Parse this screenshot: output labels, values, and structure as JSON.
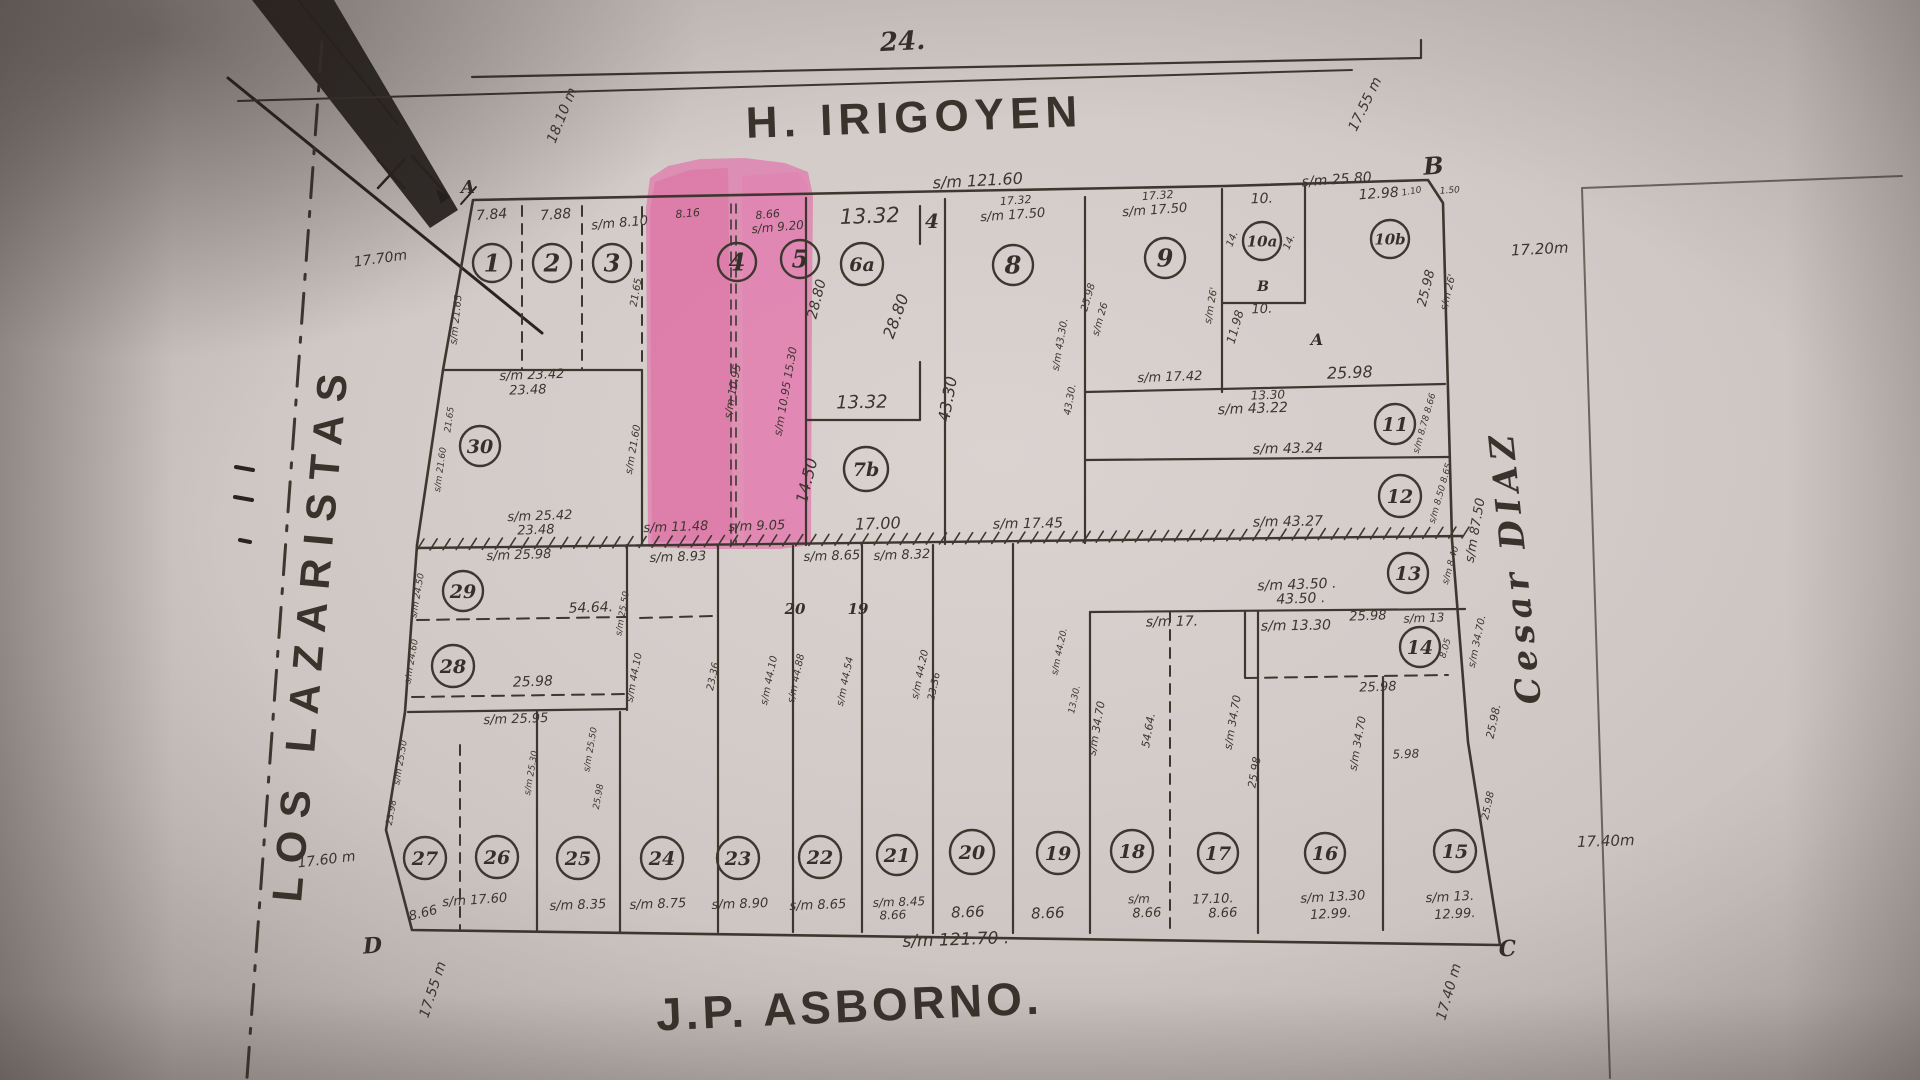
{
  "streets": {
    "top": "H. IRIGOYEN",
    "bottom": "J.P. ASBORNO.",
    "left": "LOS LAZARISTAS",
    "right": "Cesar DIAZ"
  },
  "block": {
    "across_number": "24."
  },
  "frontages": {
    "top": "s/m 121.60",
    "bottom": "s/m 121.70 ."
  },
  "colors": {
    "ink": "#3e372f",
    "paper": "#d3cbc8",
    "highlight": "#e8469a"
  },
  "highlight": {
    "lots": "4, 5"
  },
  "map": {
    "lots": [
      {
        "n": "1",
        "x": 492,
        "y": 263,
        "r": 19
      },
      {
        "n": "2",
        "x": 552,
        "y": 263,
        "r": 19
      },
      {
        "n": "3",
        "x": 612,
        "y": 263,
        "r": 19
      },
      {
        "n": "4",
        "x": 737,
        "y": 262,
        "r": 19
      },
      {
        "n": "5",
        "x": 800,
        "y": 259,
        "r": 19
      },
      {
        "n": "6a",
        "x": 862,
        "y": 264,
        "r": 21
      },
      {
        "n": "8",
        "x": 1013,
        "y": 265,
        "r": 20
      },
      {
        "n": "9",
        "x": 1165,
        "y": 258,
        "r": 20
      },
      {
        "n": "10a",
        "x": 1262,
        "y": 241,
        "r": 19
      },
      {
        "n": "10b",
        "x": 1390,
        "y": 239,
        "r": 19
      },
      {
        "n": "7b",
        "x": 866,
        "y": 469,
        "r": 22
      },
      {
        "n": "11",
        "x": 1395,
        "y": 424,
        "r": 20
      },
      {
        "n": "12",
        "x": 1400,
        "y": 496,
        "r": 21
      },
      {
        "n": "13",
        "x": 1408,
        "y": 573,
        "r": 20
      },
      {
        "n": "14",
        "x": 1420,
        "y": 647,
        "r": 20
      },
      {
        "n": "30",
        "x": 480,
        "y": 446,
        "r": 20
      },
      {
        "n": "29",
        "x": 463,
        "y": 591,
        "r": 20
      },
      {
        "n": "28",
        "x": 453,
        "y": 666,
        "r": 21
      },
      {
        "n": "27",
        "x": 425,
        "y": 858,
        "r": 21
      },
      {
        "n": "26",
        "x": 497,
        "y": 857,
        "r": 21
      },
      {
        "n": "25",
        "x": 578,
        "y": 858,
        "r": 21
      },
      {
        "n": "24",
        "x": 662,
        "y": 858,
        "r": 21
      },
      {
        "n": "23",
        "x": 738,
        "y": 858,
        "r": 21
      },
      {
        "n": "22",
        "x": 820,
        "y": 857,
        "r": 21
      },
      {
        "n": "21",
        "x": 897,
        "y": 855,
        "r": 20
      },
      {
        "n": "20",
        "x": 972,
        "y": 852,
        "r": 22
      },
      {
        "n": "19",
        "x": 1058,
        "y": 853,
        "r": 21
      },
      {
        "n": "18",
        "x": 1132,
        "y": 851,
        "r": 21
      },
      {
        "n": "17",
        "x": 1218,
        "y": 853,
        "r": 20
      },
      {
        "n": "16",
        "x": 1325,
        "y": 853,
        "r": 20
      },
      {
        "n": "15",
        "x": 1455,
        "y": 851,
        "r": 21
      }
    ],
    "labels": [
      {
        "t": "7.84",
        "x": 492,
        "y": 219,
        "r": -4,
        "s": 14
      },
      {
        "t": "7.88",
        "x": 556,
        "y": 219,
        "r": -4,
        "s": 14
      },
      {
        "t": "s/m 8.10",
        "x": 620,
        "y": 227,
        "r": -5,
        "s": 13
      },
      {
        "t": "8.16",
        "x": 688,
        "y": 217,
        "r": -5,
        "s": 11
      },
      {
        "t": "8.66",
        "x": 768,
        "y": 218,
        "r": -5,
        "s": 11
      },
      {
        "t": "s/m 9.20",
        "x": 778,
        "y": 231,
        "r": -5,
        "s": 12
      },
      {
        "t": "13.32",
        "x": 870,
        "y": 223,
        "r": -2,
        "s": 21
      },
      {
        "t": "17.32",
        "x": 1016,
        "y": 204,
        "r": -4,
        "s": 11
      },
      {
        "t": "s/m 17.50",
        "x": 1013,
        "y": 219,
        "r": -4,
        "s": 13
      },
      {
        "t": "17.32",
        "x": 1158,
        "y": 199,
        "r": -4,
        "s": 11
      },
      {
        "t": "s/m 17.50",
        "x": 1155,
        "y": 214,
        "r": -4,
        "s": 13
      },
      {
        "t": "s/m 25.80",
        "x": 1337,
        "y": 184,
        "r": -4,
        "s": 14
      },
      {
        "t": "10.",
        "x": 1262,
        "y": 203,
        "r": -2,
        "s": 14
      },
      {
        "t": "12.98",
        "x": 1379,
        "y": 198,
        "r": -4,
        "s": 14
      },
      {
        "t": "1.10",
        "x": 1412,
        "y": 194,
        "r": -10,
        "s": 9
      },
      {
        "t": "1.50",
        "x": 1450,
        "y": 193,
        "r": -4,
        "s": 9
      },
      {
        "t": "18.10 m",
        "x": 566,
        "y": 117,
        "r": -68,
        "s": 14
      },
      {
        "t": "17.70m",
        "x": 381,
        "y": 263,
        "r": -8,
        "s": 14
      },
      {
        "t": "17.55 m",
        "x": 1369,
        "y": 106,
        "r": -64,
        "s": 14
      },
      {
        "t": "17.20m",
        "x": 1540,
        "y": 254,
        "r": -3,
        "s": 15
      },
      {
        "t": "s/m 21.65",
        "x": 459,
        "y": 320,
        "r": -84,
        "s": 10
      },
      {
        "t": "21.65",
        "x": 639,
        "y": 293,
        "r": -80,
        "s": 10
      },
      {
        "t": "s/m 21.60",
        "x": 636,
        "y": 450,
        "r": -80,
        "s": 10
      },
      {
        "t": "s/m 10.95",
        "x": 736,
        "y": 392,
        "r": -80,
        "s": 11
      },
      {
        "t": "s/m 10.95 15.30",
        "x": 789,
        "y": 392,
        "r": -80,
        "s": 11
      },
      {
        "t": "28.80",
        "x": 821,
        "y": 300,
        "r": -76,
        "s": 14
      },
      {
        "t": "28.80",
        "x": 901,
        "y": 318,
        "r": -70,
        "s": 16
      },
      {
        "t": "s/m 23.42",
        "x": 532,
        "y": 379,
        "r": -2,
        "s": 13
      },
      {
        "t": "23.48",
        "x": 528,
        "y": 394,
        "r": -2,
        "s": 13
      },
      {
        "t": "21.65",
        "x": 452,
        "y": 420,
        "r": -82,
        "s": 9
      },
      {
        "t": "s/m 21.60",
        "x": 443,
        "y": 470,
        "r": -82,
        "s": 9
      },
      {
        "t": "s/m 25.42",
        "x": 540,
        "y": 520,
        "r": -2,
        "s": 13
      },
      {
        "t": "23.48",
        "x": 536,
        "y": 534,
        "r": -2,
        "s": 13
      },
      {
        "t": "13.32",
        "x": 862,
        "y": 408,
        "r": -1,
        "s": 18
      },
      {
        "t": "14.50",
        "x": 812,
        "y": 482,
        "r": -76,
        "s": 16
      },
      {
        "t": "17.00",
        "x": 878,
        "y": 529,
        "r": -2,
        "s": 16
      },
      {
        "t": "43.30",
        "x": 953,
        "y": 400,
        "r": -80,
        "s": 16
      },
      {
        "t": "s/m 17.45",
        "x": 1028,
        "y": 528,
        "r": -1,
        "s": 14
      },
      {
        "t": "s/m 43.30.",
        "x": 1063,
        "y": 345,
        "r": -80,
        "s": 10
      },
      {
        "t": "43.30.",
        "x": 1073,
        "y": 400,
        "r": -80,
        "s": 10
      },
      {
        "t": "25.98",
        "x": 1091,
        "y": 298,
        "r": -74,
        "s": 10
      },
      {
        "t": "s/m 26",
        "x": 1103,
        "y": 320,
        "r": -74,
        "s": 10
      },
      {
        "t": "s/m 17.42",
        "x": 1170,
        "y": 381,
        "r": -2,
        "s": 13
      },
      {
        "t": "s/m 26'",
        "x": 1214,
        "y": 306,
        "r": -80,
        "s": 10
      },
      {
        "t": "11.98",
        "x": 1239,
        "y": 328,
        "r": -74,
        "s": 12
      },
      {
        "t": "10.",
        "x": 1262,
        "y": 313,
        "r": -2,
        "s": 13
      },
      {
        "t": "14.",
        "x": 1235,
        "y": 240,
        "r": -68,
        "s": 10
      },
      {
        "t": "14.",
        "x": 1292,
        "y": 243,
        "r": -68,
        "s": 10
      },
      {
        "t": "25.98",
        "x": 1430,
        "y": 289,
        "r": -76,
        "s": 13
      },
      {
        "t": "s/m 26'",
        "x": 1451,
        "y": 293,
        "r": -76,
        "s": 10
      },
      {
        "t": "25.98",
        "x": 1350,
        "y": 378,
        "r": -2,
        "s": 16
      },
      {
        "t": "13.30",
        "x": 1268,
        "y": 399,
        "r": -2,
        "s": 12
      },
      {
        "t": "s/m 43.22",
        "x": 1253,
        "y": 413,
        "r": -2,
        "s": 14
      },
      {
        "t": "s/m 43.24",
        "x": 1288,
        "y": 453,
        "r": -1,
        "s": 14
      },
      {
        "t": "s/m 43.27",
        "x": 1288,
        "y": 526,
        "r": -1,
        "s": 14
      },
      {
        "t": "s/m 43.50 .",
        "x": 1297,
        "y": 589,
        "r": -2,
        "s": 14
      },
      {
        "t": "43.50 .",
        "x": 1301,
        "y": 603,
        "r": -2,
        "s": 14
      },
      {
        "t": "s/m 8.78 8.66",
        "x": 1427,
        "y": 424,
        "r": -74,
        "s": 9
      },
      {
        "t": "s/m 8.50 8.65",
        "x": 1443,
        "y": 494,
        "r": -74,
        "s": 9
      },
      {
        "t": "s/m 8.40",
        "x": 1453,
        "y": 566,
        "r": -74,
        "s": 9
      },
      {
        "t": "s/m 87.50",
        "x": 1479,
        "y": 531,
        "r": -80,
        "s": 13
      },
      {
        "t": "s/m 17.",
        "x": 1172,
        "y": 626,
        "r": -1,
        "s": 14
      },
      {
        "t": "s/m 13.30",
        "x": 1296,
        "y": 630,
        "r": -1,
        "s": 14
      },
      {
        "t": "25.98",
        "x": 1368,
        "y": 620,
        "r": -2,
        "s": 13
      },
      {
        "t": "s/m 13",
        "x": 1424,
        "y": 622,
        "r": -2,
        "s": 12
      },
      {
        "t": "8.05",
        "x": 1448,
        "y": 649,
        "r": -74,
        "s": 9
      },
      {
        "t": "25.98",
        "x": 1378,
        "y": 691,
        "r": -2,
        "s": 13
      },
      {
        "t": "s/m 34.70",
        "x": 1100,
        "y": 729,
        "r": -80,
        "s": 11
      },
      {
        "t": "54.64.",
        "x": 1152,
        "y": 731,
        "r": -80,
        "s": 11
      },
      {
        "t": "s/m 34.70",
        "x": 1236,
        "y": 723,
        "r": -80,
        "s": 11
      },
      {
        "t": "25.98",
        "x": 1258,
        "y": 773,
        "r": -80,
        "s": 11
      },
      {
        "t": "s/m 34.70",
        "x": 1361,
        "y": 744,
        "r": -80,
        "s": 11
      },
      {
        "t": "s/m 34.70.",
        "x": 1480,
        "y": 642,
        "r": -78,
        "s": 10
      },
      {
        "t": "25.98.",
        "x": 1497,
        "y": 722,
        "r": -78,
        "s": 11
      },
      {
        "t": "5.98",
        "x": 1406,
        "y": 758,
        "r": -2,
        "s": 12
      },
      {
        "t": "25.98",
        "x": 1491,
        "y": 806,
        "r": -78,
        "s": 10
      },
      {
        "t": "s/m 44.20.",
        "x": 1062,
        "y": 652,
        "r": -78,
        "s": 9
      },
      {
        "t": "13.30.",
        "x": 1077,
        "y": 700,
        "r": -78,
        "s": 9
      },
      {
        "t": "s/m 11.48",
        "x": 676,
        "y": 531,
        "r": -2,
        "s": 13
      },
      {
        "t": "s/m 9.05",
        "x": 757,
        "y": 530,
        "r": -2,
        "s": 13
      },
      {
        "t": "s/m 8.93",
        "x": 678,
        "y": 561,
        "r": -2,
        "s": 13
      },
      {
        "t": "s/m 8.65",
        "x": 832,
        "y": 560,
        "r": -2,
        "s": 13
      },
      {
        "t": "s/m 8.32",
        "x": 902,
        "y": 559,
        "r": -2,
        "s": 13
      },
      {
        "t": "s/m 25.98",
        "x": 519,
        "y": 559,
        "r": -2,
        "s": 13
      },
      {
        "t": "54.64.",
        "x": 591,
        "y": 612,
        "r": -2,
        "s": 14
      },
      {
        "t": "25.98",
        "x": 533,
        "y": 686,
        "r": -2,
        "s": 14
      },
      {
        "t": "s/m 25.95",
        "x": 516,
        "y": 723,
        "r": -2,
        "s": 13
      },
      {
        "t": "s/m 24.50",
        "x": 420,
        "y": 596,
        "r": -80,
        "s": 9
      },
      {
        "t": "s/m 24.60",
        "x": 414,
        "y": 662,
        "r": -80,
        "s": 9
      },
      {
        "t": "s/m 25.50",
        "x": 625,
        "y": 614,
        "r": -80,
        "s": 9
      },
      {
        "t": "s/m 44.10",
        "x": 637,
        "y": 678,
        "r": -79,
        "s": 10
      },
      {
        "t": "23.36",
        "x": 716,
        "y": 677,
        "r": -78,
        "s": 10
      },
      {
        "t": "s/m 44.10",
        "x": 772,
        "y": 681,
        "r": -78,
        "s": 10
      },
      {
        "t": "s/m 44.88",
        "x": 799,
        "y": 679,
        "r": -78,
        "s": 10
      },
      {
        "t": "s/m 44.54",
        "x": 848,
        "y": 682,
        "r": -78,
        "s": 10
      },
      {
        "t": "s/m 44.20",
        "x": 923,
        "y": 675,
        "r": -78,
        "s": 10
      },
      {
        "t": "23.36",
        "x": 937,
        "y": 687,
        "r": -78,
        "s": 10
      },
      {
        "t": "s/m 25.50",
        "x": 403,
        "y": 763,
        "r": -80,
        "s": 9
      },
      {
        "t": "23.98",
        "x": 394,
        "y": 813,
        "r": -80,
        "s": 9
      },
      {
        "t": "s/m 25.30.",
        "x": 534,
        "y": 772,
        "r": -80,
        "s": 9
      },
      {
        "t": "s/m 25.50",
        "x": 593,
        "y": 750,
        "r": -80,
        "s": 9
      },
      {
        "t": "25.98",
        "x": 601,
        "y": 797,
        "r": -80,
        "s": 9
      },
      {
        "t": "s/m 17.60",
        "x": 475,
        "y": 904,
        "r": -4,
        "s": 13
      },
      {
        "t": "8.66",
        "x": 424,
        "y": 917,
        "r": -14,
        "s": 13
      },
      {
        "t": "s/m 8.35",
        "x": 578,
        "y": 909,
        "r": -2,
        "s": 13
      },
      {
        "t": "s/m 8.75",
        "x": 658,
        "y": 908,
        "r": -2,
        "s": 13
      },
      {
        "t": "s/m 8.90",
        "x": 740,
        "y": 908,
        "r": -2,
        "s": 13
      },
      {
        "t": "s/m 8.65",
        "x": 818,
        "y": 909,
        "r": -2,
        "s": 13
      },
      {
        "t": "s/m 8.45",
        "x": 899,
        "y": 906,
        "r": -2,
        "s": 12
      },
      {
        "t": "8.66",
        "x": 893,
        "y": 919,
        "r": -2,
        "s": 12
      },
      {
        "t": "8.66",
        "x": 968,
        "y": 917,
        "r": -2,
        "s": 15
      },
      {
        "t": "8.66",
        "x": 1048,
        "y": 918,
        "r": -2,
        "s": 15
      },
      {
        "t": "s/m",
        "x": 1139,
        "y": 903,
        "r": -2,
        "s": 12
      },
      {
        "t": "8.66",
        "x": 1147,
        "y": 917,
        "r": -2,
        "s": 13
      },
      {
        "t": "17.10.",
        "x": 1213,
        "y": 903,
        "r": -2,
        "s": 13
      },
      {
        "t": "8.66",
        "x": 1223,
        "y": 917,
        "r": -2,
        "s": 13
      },
      {
        "t": "s/m 13.30",
        "x": 1333,
        "y": 901,
        "r": -3,
        "s": 13
      },
      {
        "t": "12.99.",
        "x": 1331,
        "y": 918,
        "r": -3,
        "s": 13
      },
      {
        "t": "s/m 13.",
        "x": 1450,
        "y": 901,
        "r": -3,
        "s": 13
      },
      {
        "t": "12.99.",
        "x": 1455,
        "y": 918,
        "r": -3,
        "s": 13
      },
      {
        "t": "17.60 m",
        "x": 327,
        "y": 864,
        "r": -7,
        "s": 14
      },
      {
        "t": "17.55 m",
        "x": 437,
        "y": 991,
        "r": -72,
        "s": 14
      },
      {
        "t": "17.40 m",
        "x": 1453,
        "y": 993,
        "r": -74,
        "s": 14
      },
      {
        "t": "17.40m",
        "x": 1606,
        "y": 846,
        "r": -2,
        "s": 15
      },
      {
        "t": "4",
        "x": 932,
        "y": 228,
        "r": 0,
        "s": 20,
        "k": "p",
        "n": "lot-number-plain"
      },
      {
        "t": "20",
        "x": 795,
        "y": 614,
        "r": 0,
        "s": 15,
        "k": "p",
        "n": "lot-number-plain"
      },
      {
        "t": "19",
        "x": 858,
        "y": 614,
        "r": 0,
        "s": 15,
        "k": "p",
        "n": "lot-number-plain"
      },
      {
        "t": "A",
        "x": 468,
        "y": 193,
        "r": 0,
        "s": 18,
        "k": "L",
        "n": "corner-letter-a"
      },
      {
        "t": "B",
        "x": 1434,
        "y": 174,
        "r": -4,
        "s": 24,
        "k": "L",
        "n": "corner-letter-b"
      },
      {
        "t": "C",
        "x": 1508,
        "y": 956,
        "r": -4,
        "s": 22,
        "k": "L",
        "n": "corner-letter-c"
      },
      {
        "t": "D",
        "x": 373,
        "y": 953,
        "r": -4,
        "s": 22,
        "k": "L",
        "n": "corner-letter-d"
      },
      {
        "t": "B",
        "x": 1263,
        "y": 291,
        "r": 0,
        "s": 14,
        "k": "L",
        "n": "sublot-letter-b"
      },
      {
        "t": "A",
        "x": 1317,
        "y": 345,
        "r": 0,
        "s": 16,
        "k": "L",
        "n": "sublot-letter-a"
      }
    ]
  }
}
